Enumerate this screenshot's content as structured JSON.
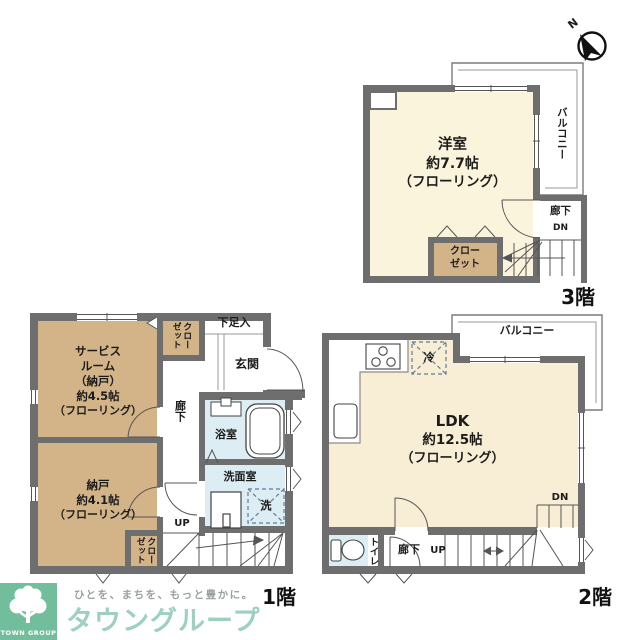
{
  "compass": {
    "north": "N"
  },
  "floor3": {
    "label": "3階",
    "room_name": "洋室",
    "room_size": "約7.7帖",
    "room_floor": "（フローリング）",
    "balcony": "バルコニー",
    "hallway": "廊下",
    "down": "DN",
    "closet": "クローゼット"
  },
  "floor1": {
    "label": "1階",
    "service_room_lines": [
      "サービス",
      "ルーム",
      "（納戸）",
      "約4.5帖",
      "（フローリング）"
    ],
    "storage_lines": [
      "納戸",
      "約4.1帖",
      "（フローリング）"
    ],
    "closet_upper": "クローゼット",
    "closet_lower": "クローゼット",
    "shoe_cabinet": "下足入",
    "entrance": "玄関",
    "hallway": "廊下",
    "bathroom": "浴室",
    "washroom": "洗面室",
    "laundry": "洗",
    "up": "UP"
  },
  "floor2": {
    "label": "2階",
    "ldk_lines": [
      "LDK",
      "約12.5帖",
      "（フローリング）"
    ],
    "balcony": "バルコニー",
    "toilet": "トイレ",
    "hallway": "廊下",
    "up": "UP",
    "down": "DN",
    "fridge": "冷"
  },
  "brand": {
    "tagline": "ひとを、まちを、もっと豊かに。",
    "company": "タウングループ",
    "logo_caption": "TOWN GROUP"
  },
  "colors": {
    "wall": "#6e6e6e",
    "room_cream": "#FAF4DC",
    "ldk_cream": "#F8EED6",
    "storage_tan": "#D3B488",
    "wet_blue": "#DCEDF3",
    "brand_green": "#72BE9C",
    "brand_text": "#9ED0BF"
  }
}
